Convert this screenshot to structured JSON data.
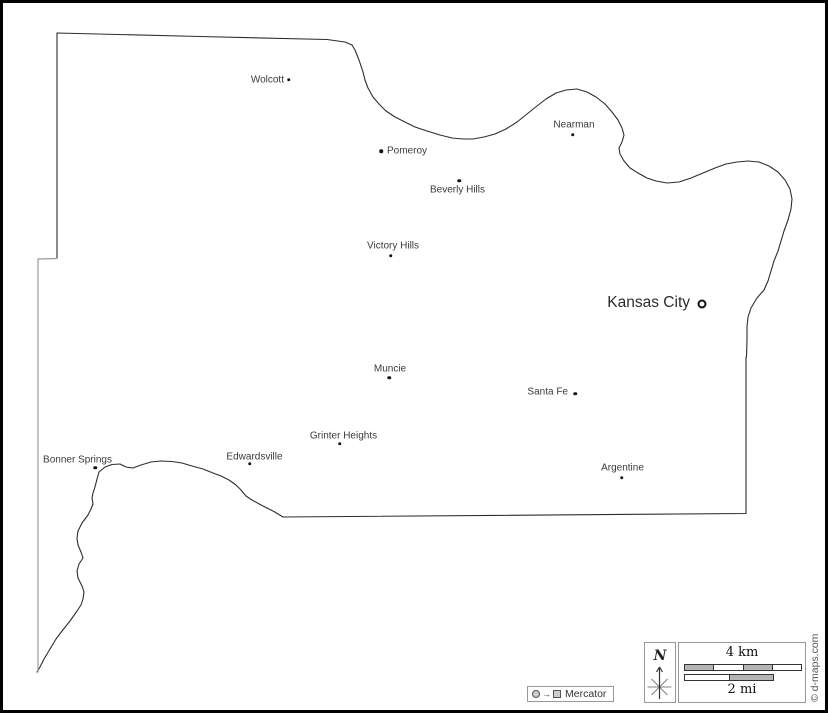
{
  "colors": {
    "border_dark": "#2d2d2d",
    "border_light": "#9a9a9a",
    "label_text": "#3a3a3a",
    "scale_bar_fill": "#b5b5b5",
    "box_border": "#999999"
  },
  "map": {
    "cities": [
      {
        "name": "Wolcott"
      },
      {
        "name": "Pomeroy"
      },
      {
        "name": "Nearman"
      },
      {
        "name": "Beverly Hills"
      },
      {
        "name": "Victory Hills"
      },
      {
        "name": "Muncie"
      },
      {
        "name": "Santa Fe"
      },
      {
        "name": "Grinter Heights"
      },
      {
        "name": "Edwardsville"
      },
      {
        "name": "Bonner Springs"
      },
      {
        "name": "Argentine"
      }
    ],
    "capital": {
      "name": "Kansas City"
    }
  },
  "legend": {
    "arrow": "→",
    "projection": "Mercator"
  },
  "compass": {
    "north": "N"
  },
  "scale": {
    "km": "4 km",
    "mi": "2 mi"
  },
  "credit": "© d-maps.com"
}
